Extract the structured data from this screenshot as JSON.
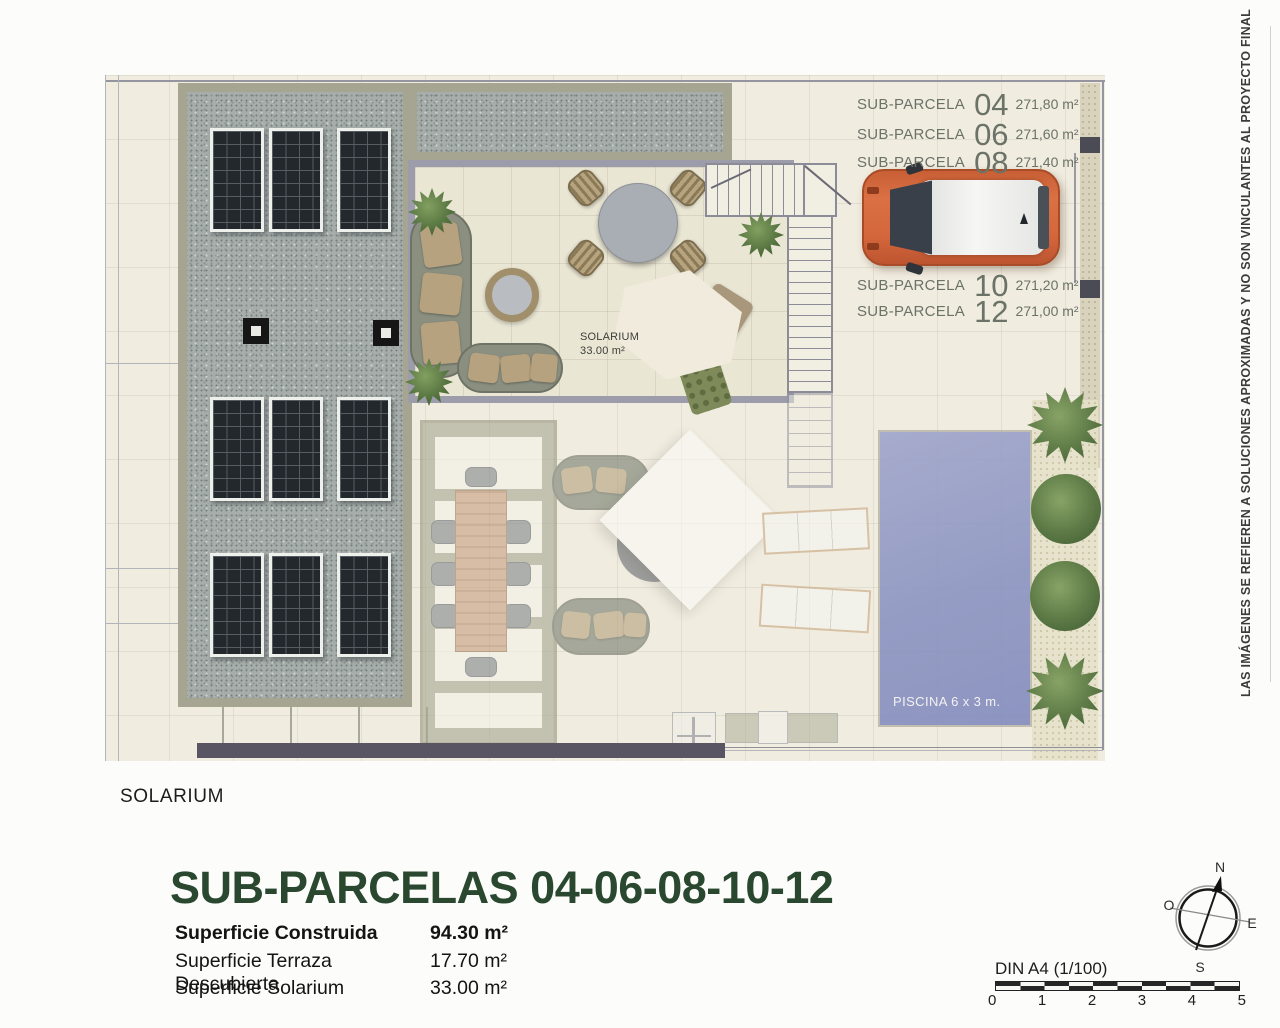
{
  "disclaimer": "LAS IMÁGENES SE REFIEREN A SOLUCIONES APROXIMADAS Y NO SON VINCULANTES AL PROYECTO FINAL",
  "plan": {
    "subparcelas": [
      {
        "prefix": "SUB-PARCELA",
        "number": "04",
        "area": "271,80 m²"
      },
      {
        "prefix": "SUB-PARCELA",
        "number": "06",
        "area": "271,60 m²"
      },
      {
        "prefix": "SUB-PARCELA",
        "number": "08",
        "area": "271,40 m²"
      },
      {
        "prefix": "SUB-PARCELA",
        "number": "10",
        "area": "271,20 m²"
      },
      {
        "prefix": "SUB-PARCELA",
        "number": "12",
        "area": "271,00 m²"
      }
    ],
    "solarium_annotation": {
      "line1": "SOLARIUM",
      "line2": "33.00 m²"
    },
    "pool_label": "PISCINA 6 x 3 m."
  },
  "footer": {
    "floor_label": "SOLARIUM",
    "title": "SUB-PARCELAS 04-06-08-10-12",
    "surfaces": [
      {
        "label": "Superficie Construida",
        "value": "94.30 m²"
      },
      {
        "label": "Superficie Terraza Descubierta",
        "value": "17.70 m²"
      },
      {
        "label": "Superficie Solarium",
        "value": "33.00 m²"
      }
    ]
  },
  "compass": {
    "n": "N",
    "s": "S",
    "e": "E",
    "w": "O"
  },
  "scale": {
    "label": "DIN A4 (1/100)",
    "ticks": [
      "0",
      "1",
      "2",
      "3",
      "4",
      "5"
    ]
  },
  "colors": {
    "accent_orange": "#d4663c",
    "pool_blue": "#8b93c4",
    "title_green": "#2a4830",
    "gravel": "#a6adaa"
  }
}
